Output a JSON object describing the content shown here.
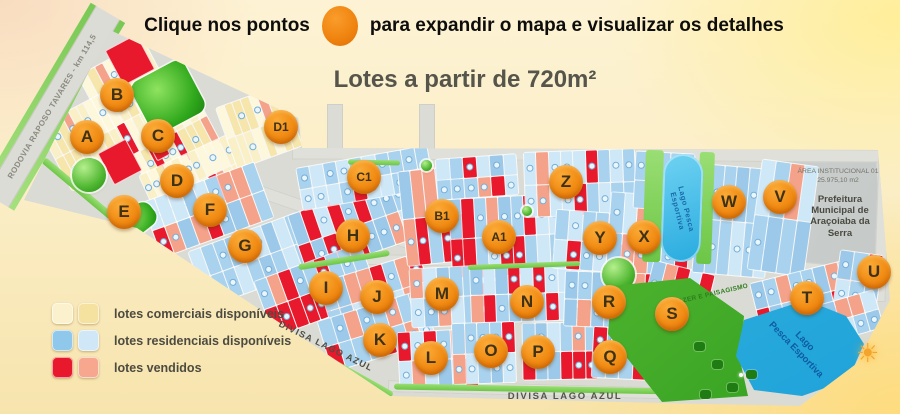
{
  "header": {
    "instruction_prefix": "Clique nos pontos",
    "instruction_suffix": "para expandir o mapa e visualizar os detalhes",
    "subtitle": "Lotes a partir de 720m²"
  },
  "legend": {
    "items": [
      {
        "label": "lotes comerciais disponíveis",
        "colors": [
          "#fbf2cd",
          "#f6e2a0"
        ]
      },
      {
        "label": "lotes residenciais disponíveis",
        "colors": [
          "#8fc8ea",
          "#cfe7f7"
        ]
      },
      {
        "label": "lotes vendidos",
        "colors": [
          "#e8192c",
          "#f6a78e"
        ]
      }
    ]
  },
  "map": {
    "labels": {
      "rodovia": "RODOVIA RAPOSO TAVARES  -  km 114,5",
      "divisa_diagonal": "DIVISA LAGO AZUL",
      "divisa_bottom": "DIVISA LAGO AZUL",
      "area_institucional_1": "ÁREA INSTITUCIONAL 01",
      "area_institucional_2": "25.975,10 m2",
      "prefeitura": "Prefeitura Municipal de Araçoiaba da Serra",
      "lago_top": "Lago Pesca Esportiva",
      "lago_bottom_1": "Lago",
      "lago_bottom_2": "Pesca Esportiva",
      "lazer": "LAZER E PAISAGISMO",
      "sun_icon": "☀"
    },
    "palette": {
      "accent_orange": "#f0870f",
      "road": "#dbdbd5",
      "res_base": "#a8d2ee",
      "res_light": "#cfe8f8",
      "res_mid": "#9cc9e9",
      "com_base": "#faf0c8",
      "com_light": "#fdf7dc",
      "com_mid": "#f6e6ab",
      "sold_red": "#e8192c",
      "sold_salmon": "#f5a28b",
      "green": "#46b832",
      "lake": "#35b7e8"
    },
    "markers": [
      {
        "label": "A",
        "x": 87,
        "y": 137
      },
      {
        "label": "B",
        "x": 117,
        "y": 95
      },
      {
        "label": "C",
        "x": 158,
        "y": 136
      },
      {
        "label": "D",
        "x": 177,
        "y": 181
      },
      {
        "label": "E",
        "x": 124,
        "y": 212
      },
      {
        "label": "F",
        "x": 210,
        "y": 210
      },
      {
        "label": "G",
        "x": 245,
        "y": 246
      },
      {
        "label": "H",
        "x": 353,
        "y": 236
      },
      {
        "label": "I",
        "x": 326,
        "y": 288
      },
      {
        "label": "J",
        "x": 377,
        "y": 297
      },
      {
        "label": "K",
        "x": 380,
        "y": 340
      },
      {
        "label": "L",
        "x": 431,
        "y": 358
      },
      {
        "label": "M",
        "x": 442,
        "y": 294
      },
      {
        "label": "N",
        "x": 527,
        "y": 302
      },
      {
        "label": "O",
        "x": 491,
        "y": 351
      },
      {
        "label": "P",
        "x": 538,
        "y": 352
      },
      {
        "label": "Q",
        "x": 610,
        "y": 357
      },
      {
        "label": "R",
        "x": 609,
        "y": 302
      },
      {
        "label": "S",
        "x": 672,
        "y": 314
      },
      {
        "label": "T",
        "x": 807,
        "y": 298
      },
      {
        "label": "U",
        "x": 874,
        "y": 272
      },
      {
        "label": "V",
        "x": 780,
        "y": 197
      },
      {
        "label": "W",
        "x": 729,
        "y": 202
      },
      {
        "label": "X",
        "x": 644,
        "y": 237
      },
      {
        "label": "Y",
        "x": 600,
        "y": 238
      },
      {
        "label": "Z",
        "x": 566,
        "y": 182
      },
      {
        "label": "A1",
        "x": 499,
        "y": 237
      },
      {
        "label": "B1",
        "x": 442,
        "y": 216
      },
      {
        "label": "C1",
        "x": 364,
        "y": 177
      },
      {
        "label": "D1",
        "x": 281,
        "y": 127
      }
    ],
    "outline": [
      [
        110,
        30
      ],
      [
        298,
        118
      ],
      [
        302,
        148
      ],
      [
        878,
        150
      ],
      [
        890,
        300
      ],
      [
        856,
        364
      ],
      [
        800,
        406
      ],
      [
        660,
        403
      ],
      [
        390,
        396
      ],
      [
        137,
        228
      ],
      [
        24,
        200
      ]
    ],
    "stubs": [
      [
        327,
        104,
        14,
        52
      ],
      [
        419,
        104,
        14,
        54
      ]
    ],
    "roads": [
      [
        292,
        148,
        590,
        13,
        0.3
      ],
      [
        188,
        209,
        282,
        13,
        19
      ],
      [
        318,
        256,
        330,
        11,
        1
      ],
      [
        648,
        258,
        240,
        10,
        6
      ],
      [
        388,
        384,
        300,
        12,
        1.5
      ],
      [
        876,
        152,
        12,
        150,
        2
      ]
    ],
    "institutional": [
      [
        786,
        158
      ],
      [
        876,
        153
      ],
      [
        882,
        286
      ],
      [
        806,
        262
      ]
    ],
    "blocks": [
      [
        "c",
        88,
        54,
        76,
        66,
        -28,
        0.12
      ],
      [
        "c",
        50,
        104,
        78,
        74,
        -28,
        0.08
      ],
      [
        "c",
        126,
        102,
        86,
        66,
        -28,
        0.1
      ],
      [
        "c",
        146,
        152,
        98,
        60,
        -25,
        0.1
      ],
      [
        "c",
        224,
        94,
        70,
        66,
        -20,
        0.06
      ],
      [
        "r",
        148,
        180,
        120,
        60,
        -20,
        0.3
      ],
      [
        "r",
        194,
        230,
        116,
        60,
        -20,
        0.25
      ],
      [
        "r",
        294,
        194,
        120,
        64,
        -19,
        0.3
      ],
      [
        "r",
        298,
        156,
        134,
        44,
        -10,
        0.25
      ],
      [
        "r",
        260,
        260,
        114,
        60,
        -20,
        0.35
      ],
      [
        "r",
        324,
        266,
        106,
        60,
        -17,
        0.3
      ],
      [
        "r",
        322,
        304,
        110,
        54,
        -17,
        0.35
      ],
      [
        "r",
        402,
        168,
        62,
        96,
        -6,
        0.55
      ],
      [
        "r",
        450,
        196,
        112,
        80,
        -3,
        0.5
      ],
      [
        "r",
        524,
        150,
        112,
        66,
        -2,
        0.45
      ],
      [
        "r",
        436,
        156,
        82,
        42,
        -4,
        0.3
      ],
      [
        "r",
        410,
        266,
        94,
        60,
        -3,
        0.35
      ],
      [
        "r",
        470,
        264,
        114,
        58,
        -2,
        0.3
      ],
      [
        "r",
        398,
        330,
        80,
        58,
        -3,
        0.4
      ],
      [
        "r",
        452,
        322,
        64,
        62,
        -2,
        0.35
      ],
      [
        "r",
        522,
        322,
        76,
        58,
        -1,
        0.3
      ],
      [
        "r",
        554,
        212,
        94,
        60,
        4,
        0.15
      ],
      [
        "r",
        608,
        194,
        82,
        82,
        4,
        0.6
      ],
      [
        "r",
        564,
        272,
        94,
        56,
        2,
        0.5
      ],
      [
        "r",
        592,
        328,
        82,
        52,
        3,
        0.4
      ],
      [
        "r",
        642,
        266,
        64,
        88,
        14,
        0.5
      ],
      [
        "r",
        634,
        152,
        60,
        58,
        3,
        0.35
      ],
      [
        "r",
        696,
        166,
        74,
        110,
        5,
        0.2
      ],
      [
        "r",
        754,
        162,
        58,
        112,
        8,
        0.35
      ],
      [
        "r",
        754,
        270,
        104,
        54,
        -14,
        0.35
      ],
      [
        "r",
        836,
        252,
        44,
        58,
        8,
        0.3
      ],
      [
        "r",
        824,
        296,
        56,
        40,
        -16,
        0.35
      ]
    ],
    "solids": [
      [
        112,
        40,
        34,
        38,
        -28
      ],
      [
        104,
        144,
        30,
        34,
        -28
      ],
      [
        152,
        140,
        13,
        17,
        -28
      ]
    ],
    "greens": {
      "bars": [
        [
          348,
          160,
          52,
          5,
          1
        ],
        [
          468,
          263,
          112,
          5,
          -2
        ],
        [
          298,
          257,
          92,
          6,
          -9
        ],
        [
          394,
          386,
          282,
          6,
          1
        ],
        [
          21,
          218,
          192,
          7,
          40
        ],
        [
          172,
          335,
          235,
          7,
          29
        ],
        [
          644,
          150,
          18,
          112,
          2
        ],
        [
          698,
          152,
          15,
          112,
          2
        ]
      ],
      "balls": [
        [
          72,
          158,
          34
        ],
        [
          602,
          258,
          33
        ]
      ],
      "dots": [
        [
          421,
          160,
          11
        ],
        [
          522,
          206,
          10
        ]
      ],
      "parks": [
        [
          138,
          68,
          60,
          58,
          -28
        ],
        [
          122,
          206,
          34,
          26,
          -38
        ]
      ]
    },
    "park_polygon": [
      [
        612,
        286
      ],
      [
        690,
        278
      ],
      [
        744,
        316
      ],
      [
        740,
        360
      ],
      [
        748,
        396
      ],
      [
        662,
        402
      ],
      [
        608,
        334
      ]
    ],
    "lake_bottom": [
      [
        744,
        320
      ],
      [
        806,
        300
      ],
      [
        846,
        316
      ],
      [
        864,
        344
      ],
      [
        848,
        380
      ],
      [
        802,
        396
      ],
      [
        754,
        390
      ],
      [
        736,
        356
      ]
    ],
    "lake_top": [
      662,
      154,
      40,
      108,
      2
    ],
    "trees": [
      [
        694,
        342
      ],
      [
        712,
        360
      ],
      [
        727,
        383
      ],
      [
        746,
        370
      ],
      [
        700,
        390
      ]
    ],
    "sparkle": [
      739,
      373
    ]
  }
}
